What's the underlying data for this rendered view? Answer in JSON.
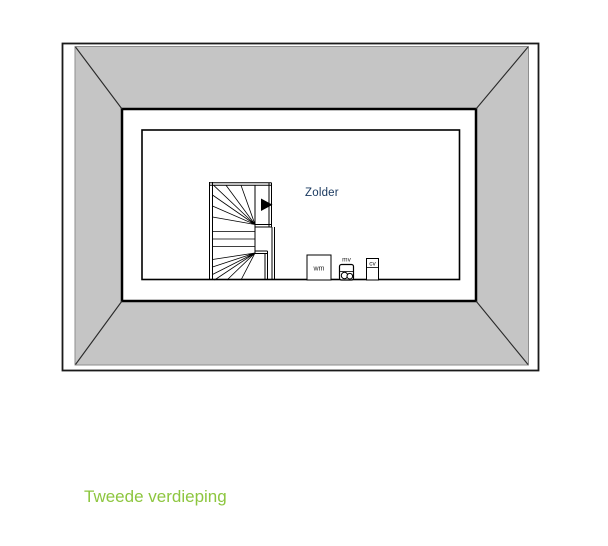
{
  "floorplan": {
    "room_label": "Zolder",
    "floor_title": "Tweede verdieping",
    "appliances": {
      "washing_machine": "wm",
      "mechanical_ventilation": "mv",
      "central_heating": "cv"
    },
    "colors": {
      "roof_fill": "#c5c5c5",
      "roof_edge": "#8e8e8e",
      "line": "#000000",
      "room_label_color": "#17375e",
      "floor_title_color": "#8dc63f"
    }
  }
}
